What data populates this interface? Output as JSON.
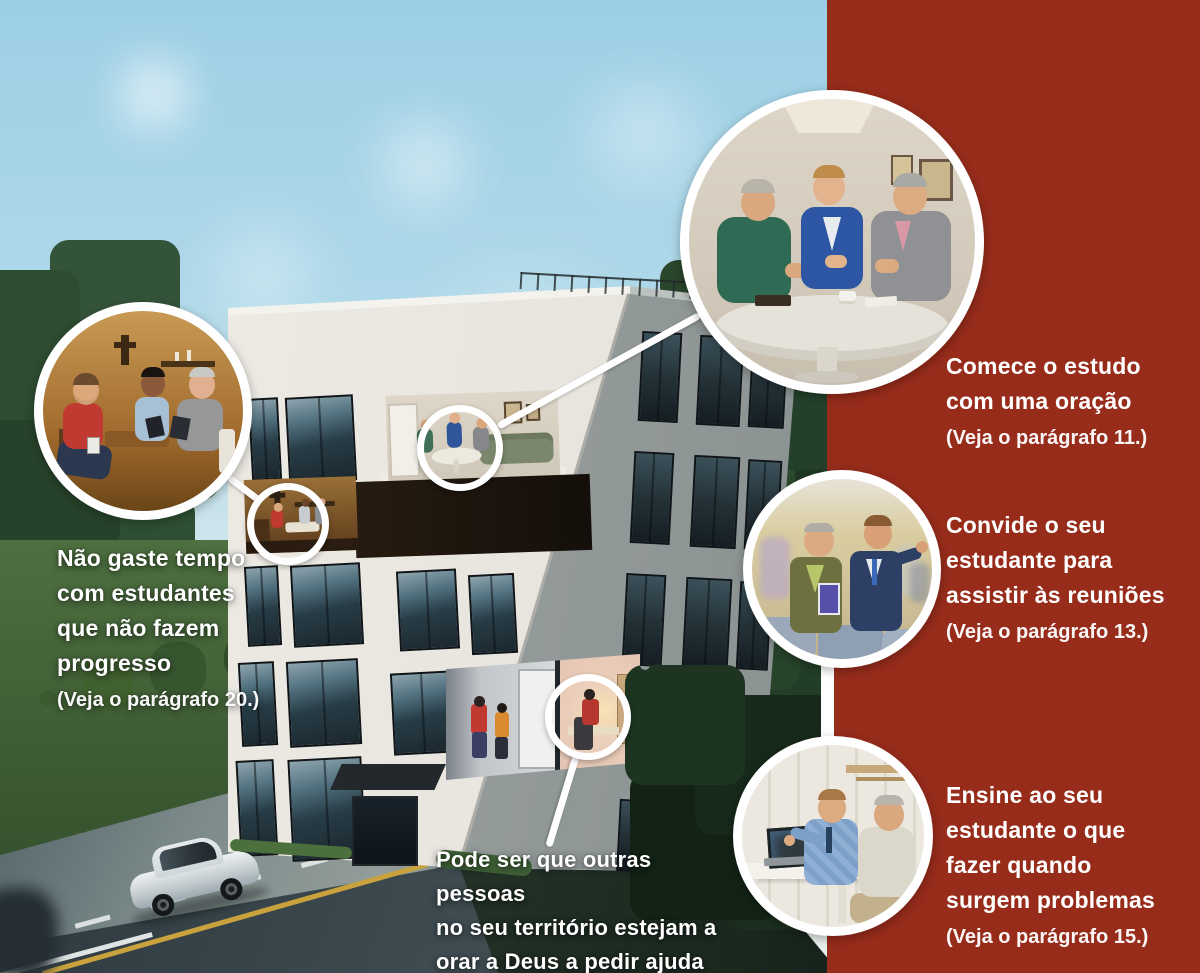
{
  "colors": {
    "band_red": "#972c1b",
    "ring_white": "#ffffff",
    "caption_white": "#ffffff"
  },
  "captions": {
    "start_study": {
      "lines": [
        "Comece o estudo",
        "com uma oração"
      ],
      "ref": "(Veja o parágrafo 11.)"
    },
    "invite_meetings": {
      "lines": [
        "Convide o seu",
        "estudante para",
        "assistir às reuniões"
      ],
      "ref": "(Veja o parágrafo 13.)"
    },
    "handle_problems": {
      "lines": [
        "Ensine ao seu",
        "estudante o que",
        "fazer quando",
        "surgem problemas"
      ],
      "ref": "(Veja o parágrafo 15.)"
    },
    "no_progress": {
      "lines": [
        "Não gaste tempo",
        "com estudantes",
        "que não fazem",
        "progresso"
      ],
      "ref": "(Veja o parágrafo 20.)"
    },
    "others_praying": {
      "lines": [
        "Pode ser que outras pessoas",
        "no seu território estejam a",
        "orar a Deus a pedir ajuda"
      ],
      "ref": "(Veja o parágrafo 20.)"
    }
  }
}
